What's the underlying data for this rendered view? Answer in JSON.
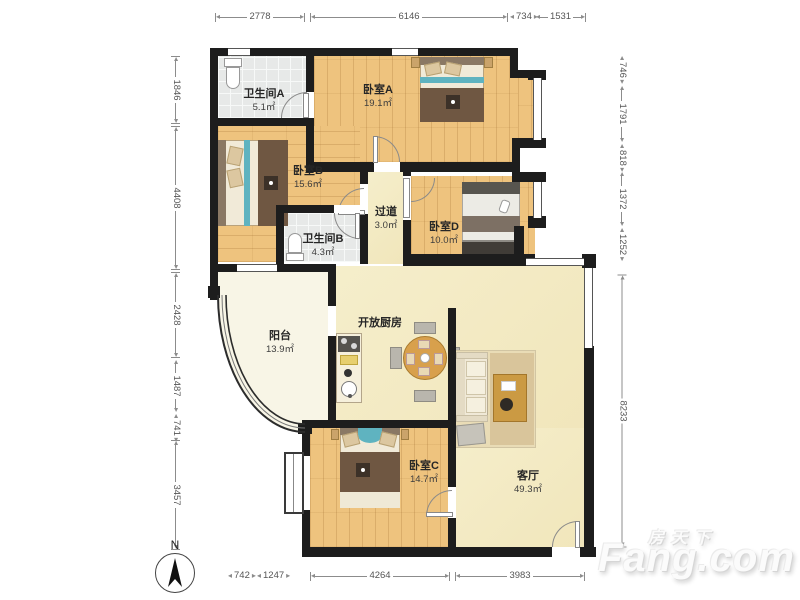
{
  "title": "户型图",
  "rooms": [
    {
      "name": "卫生间A",
      "area": "5.1㎡"
    },
    {
      "name": "卧室A",
      "area": "19.1㎡"
    },
    {
      "name": "卧室B",
      "area": "15.6㎡"
    },
    {
      "name": "过道",
      "area": "3.0㎡"
    },
    {
      "name": "卧室D",
      "area": "10.0㎡"
    },
    {
      "name": "卫生间B",
      "area": "4.3㎡"
    },
    {
      "name": "阳台",
      "area": "13.9㎡"
    },
    {
      "name": "开放厨房",
      "area": ""
    },
    {
      "name": "卧室C",
      "area": "14.7㎡"
    },
    {
      "name": "客厅",
      "area": "49.3㎡"
    }
  ],
  "dimensions": {
    "top": [
      "2778",
      "6146",
      "734",
      "1531"
    ],
    "bottom": [
      "742",
      "1247",
      "4264",
      "3983"
    ],
    "left": [
      "1846",
      "4408",
      "2428",
      "1487",
      "741",
      "3457"
    ],
    "right": [
      "746",
      "1791",
      "818",
      "1372",
      "1252",
      "8233"
    ]
  },
  "compass": {
    "label": "N"
  },
  "watermark": {
    "line1": "房天下",
    "line2": "Fang.com"
  },
  "colors": {
    "wall": "#1d1d1d",
    "wood_floor": "#eec37e",
    "tile_floor": "#e7e9e8",
    "open_area_floor": "#f3ecc6",
    "balcony_floor": "#f8f5e6",
    "teal_accent": "#5fb3c0",
    "blanket_brown": "#6f5742",
    "dim_text": "#555555"
  }
}
